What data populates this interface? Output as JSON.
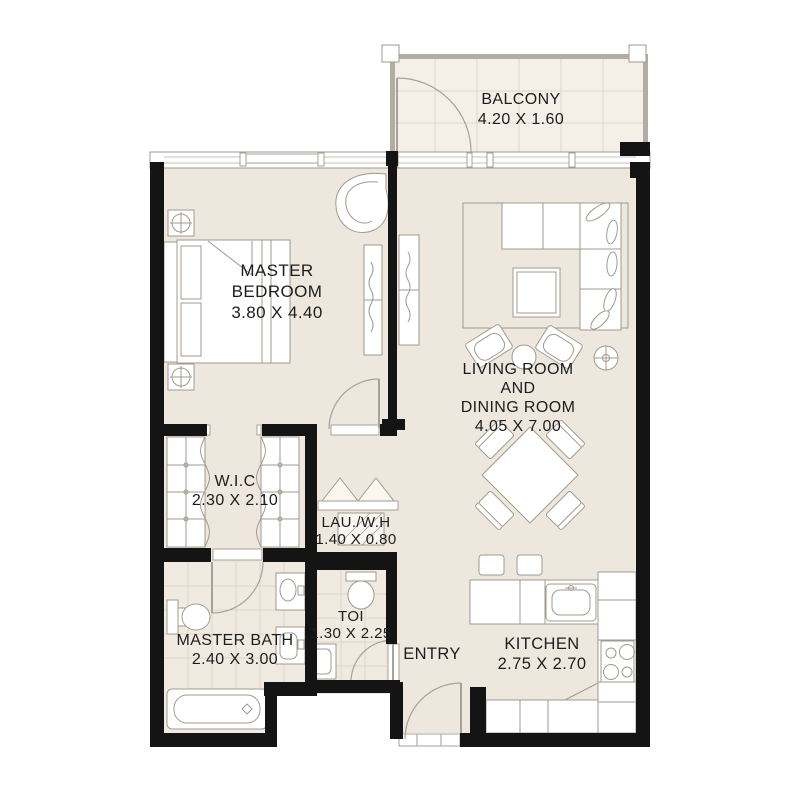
{
  "title": "Apartment Floor Plan",
  "colors": {
    "background": "#ffffff",
    "wall": "#141414",
    "floor": "#ede7de",
    "floor_balcony": "#f6efe7",
    "floor_bath": "#f1eae1",
    "furniture_line": "#a09a90",
    "tile_line": "#ddd2c3",
    "door_line": "#a8a199",
    "text": "#1d1d1d"
  },
  "rooms": {
    "balcony": {
      "lines": [
        "BALCONY",
        "4.20 X 1.60"
      ]
    },
    "master_bedroom": {
      "lines": [
        "MASTER",
        "BEDROOM",
        "3.80 X 4.40"
      ]
    },
    "living_dining": {
      "lines": [
        "LIVING ROOM",
        "AND",
        "DINING ROOM",
        "4.05 X 7.00"
      ]
    },
    "wic": {
      "lines": [
        "W.I.C",
        "2.30 X 2.10"
      ]
    },
    "laundry": {
      "lines": [
        "LAU./W.H",
        "1.40 X 0.80"
      ]
    },
    "master_bath": {
      "lines": [
        "MASTER BATH",
        "2.40 X 3.00"
      ]
    },
    "toi": {
      "lines": [
        "TOI",
        "1.30 X 2.25"
      ]
    },
    "entry": {
      "lines": [
        "ENTRY"
      ]
    },
    "kitchen": {
      "lines": [
        "KITCHEN",
        "2.75 X 2.70"
      ]
    }
  }
}
